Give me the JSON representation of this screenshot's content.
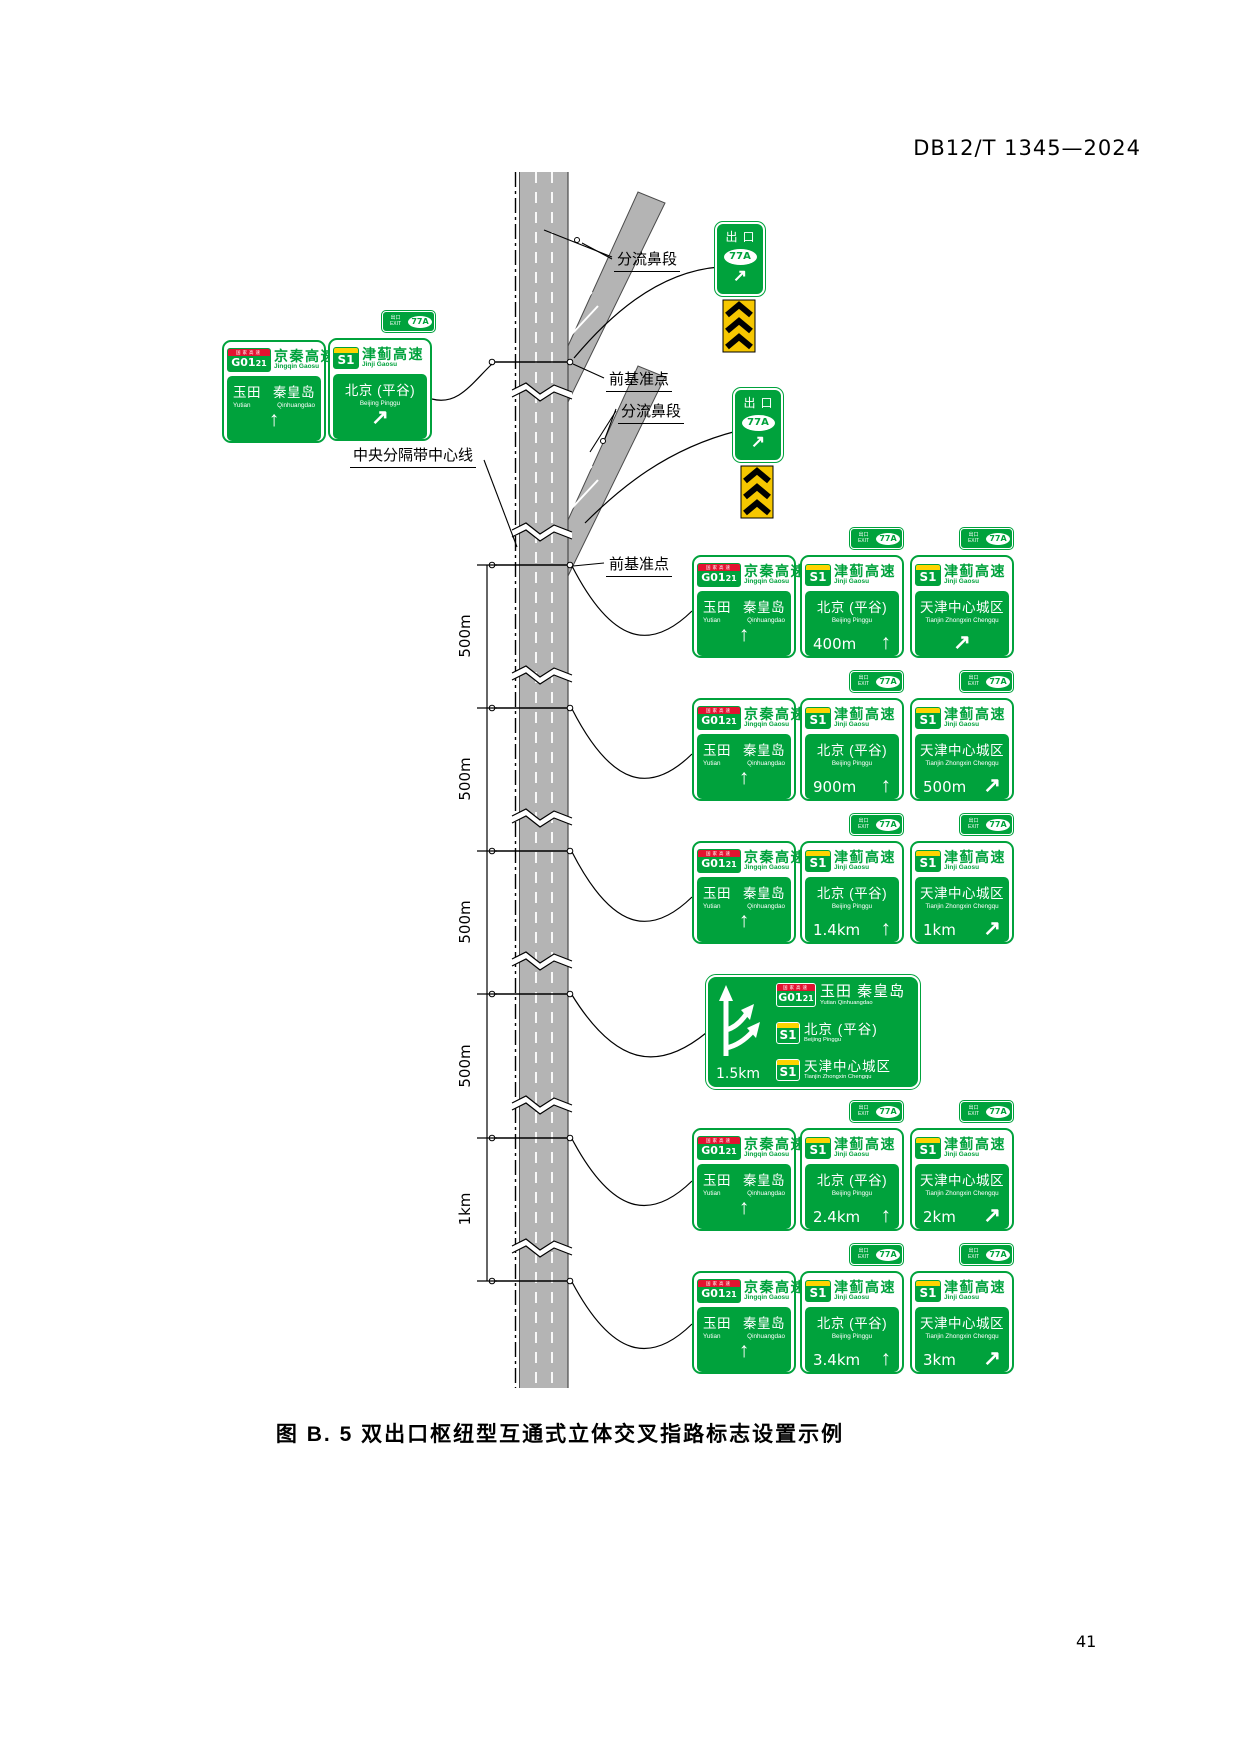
{
  "page": {
    "header": "DB12/T 1345—2024",
    "caption": "图 B. 5  双出口枢纽型互通式立体交叉指路标志设置示例",
    "page_number": "41"
  },
  "annotations": {
    "diverge_nose_top": "分流鼻段",
    "datum_top": "前基准点",
    "diverge_nose_bottom": "分流鼻段",
    "datum_bottom": "前基准点",
    "median_centerline": "中央分隔带中心线"
  },
  "scale_segments": [
    "500m",
    "500m",
    "500m",
    "500m",
    "1km"
  ],
  "icons": {
    "up_arrow": "↑",
    "up_right_arrow": "↗"
  },
  "exit_sign": {
    "label": "出口",
    "number": "77A"
  },
  "exit_plaque": {
    "zh": "出口",
    "en": "EXIT",
    "number": "77A"
  },
  "g_route": {
    "band": "国家高速",
    "code_main": "G01",
    "code_sub": "21",
    "name": "京秦高速",
    "pinyin": "Jingqin Gaosu"
  },
  "s_route": {
    "code": "S1",
    "name": "津蓟高速",
    "pinyin": "Jinji Gaosu"
  },
  "dest": {
    "yutian": {
      "zh1": "玉田",
      "zh2": "秦皇岛",
      "py1": "Yutian",
      "py2": "Qinhuangdao",
      "zh_joined": "玉田 秦皇岛",
      "py_joined": "Yutian  Qinhuangdao"
    },
    "beijing": {
      "zh": "北京 (平谷)",
      "py": "Beijing Pinggu"
    },
    "tianjin": {
      "zh": "天津中心城区",
      "py": "Tianjin Zhongxin Chengqu"
    }
  },
  "groups": [
    {
      "middle_distance": "400m",
      "right_distance": ""
    },
    {
      "middle_distance": "900m",
      "right_distance": "500m"
    },
    {
      "middle_distance": "1.4km",
      "right_distance": "1km"
    },
    {
      "middle_distance": "2.4km",
      "right_distance": "2km"
    },
    {
      "middle_distance": "3.4km",
      "right_distance": "3km"
    }
  ],
  "big_sign": {
    "distance": "1.5km"
  },
  "colors": {
    "sign_green": "#00a23c",
    "shield_red": "#e31230",
    "shield_yellow": "#ffd400",
    "road_gray": "#b4b4b4",
    "marker_yellow": "#f6c700"
  }
}
